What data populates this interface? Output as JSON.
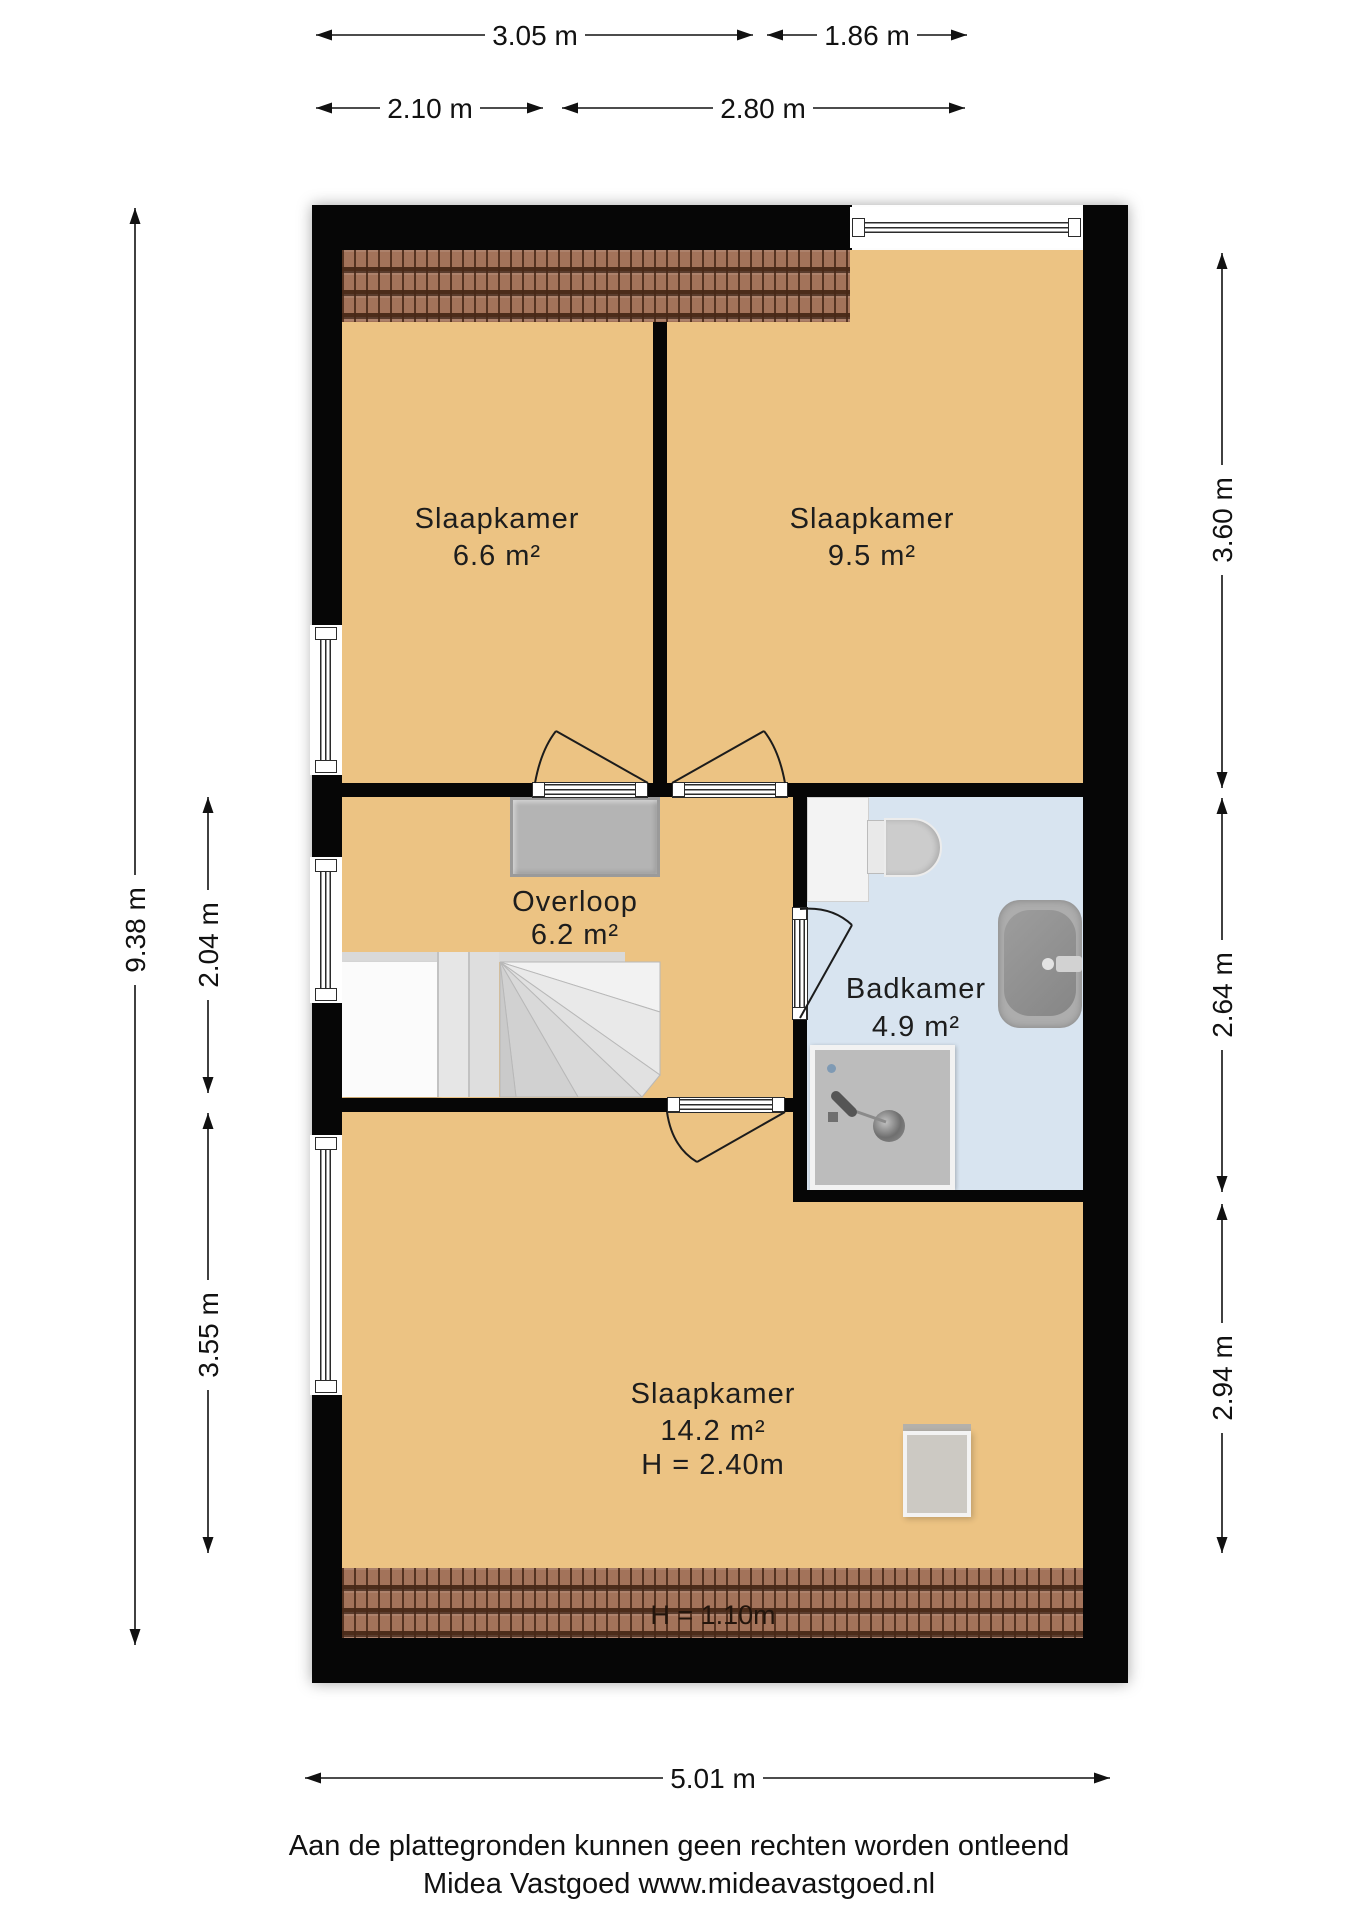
{
  "colors": {
    "floor": "#ecc383",
    "bathroom_floor": "#d8e4f0",
    "wall": "#060606",
    "roof_tile": "#a3735a"
  },
  "rooms": {
    "bedroom_top_left": {
      "name": "Slaapkamer",
      "area": "6.6 m²"
    },
    "bedroom_top_right": {
      "name": "Slaapkamer",
      "area": "9.5 m²"
    },
    "landing": {
      "name": "Overloop",
      "area": "6.2 m²"
    },
    "bathroom": {
      "name": "Badkamer",
      "area": "4.9 m²"
    },
    "bedroom_bottom": {
      "name": "Slaapkamer",
      "area": "14.2 m²",
      "ceiling_height": "H = 2.40m"
    },
    "roof_edge_note": "H = 1.10m"
  },
  "dimensions": {
    "width_top_left": "3.05 m",
    "width_top_right": "1.86 m",
    "width_room_left": "2.10 m",
    "width_room_right": "2.80 m",
    "height_total": "9.38 m",
    "height_landing": "2.04 m",
    "height_bottom_left": "3.55 m",
    "height_bedroom_right": "3.60 m",
    "height_bathroom": "2.64 m",
    "height_bottom_right": "2.94 m",
    "width_bottom": "5.01 m"
  },
  "footer": {
    "disclaimer": "Aan de plattegronden kunnen geen rechten worden ontleend",
    "company": "Midea Vastgoed www.mideavastgoed.nl"
  }
}
